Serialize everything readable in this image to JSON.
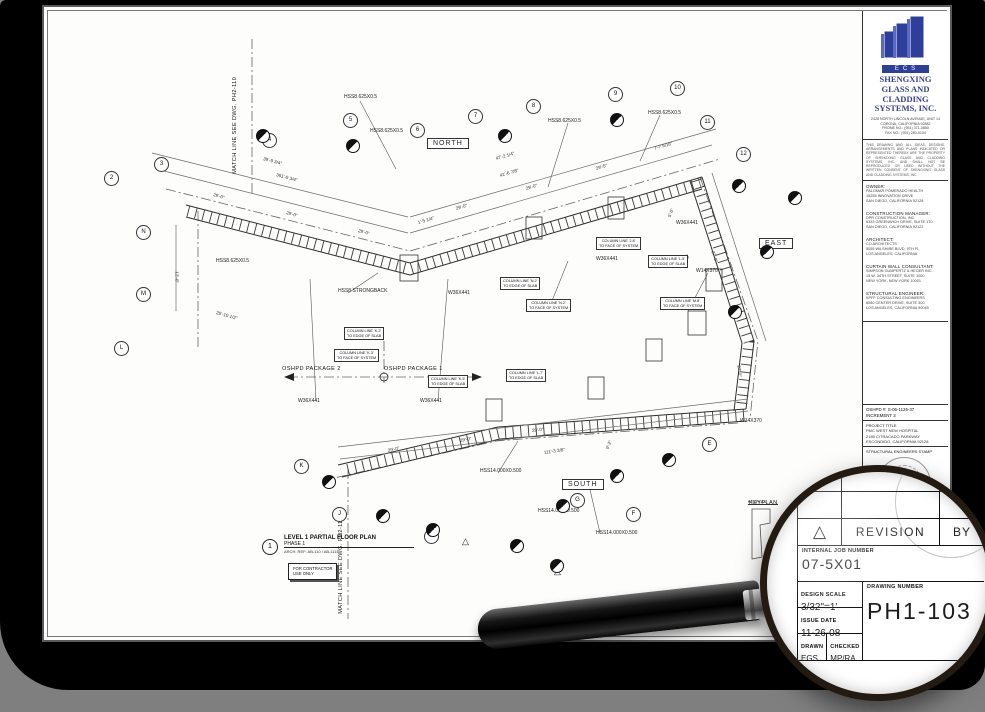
{
  "colors": {
    "canvas_bg": "#7f7f7f",
    "frame": "#000000",
    "sheet": "#fdfdfc",
    "logo_blue": "#2e3f9b",
    "company_text": "#39418e"
  },
  "plan": {
    "orientation": [
      {
        "t": "NORTH",
        "x": 379,
        "y": 127
      },
      {
        "t": "EAST",
        "x": 711,
        "y": 227
      },
      {
        "t": "SOUTH",
        "x": 514,
        "y": 468
      }
    ],
    "members": [
      {
        "t": "HSS8.625X0.5",
        "x": 296,
        "y": 84
      },
      {
        "t": "HSS8.625X0.5",
        "x": 322,
        "y": 118
      },
      {
        "t": "HSS8.625X0.5",
        "x": 500,
        "y": 108
      },
      {
        "t": "HSS8.625X0.5",
        "x": 600,
        "y": 100
      },
      {
        "t": "HSS8.625X0.5",
        "x": 168,
        "y": 248
      },
      {
        "t": "HSS8 STRONGBACK",
        "x": 290,
        "y": 278
      },
      {
        "t": "W36X441",
        "x": 250,
        "y": 388
      },
      {
        "t": "W36X441",
        "x": 372,
        "y": 388
      },
      {
        "t": "W36X441",
        "x": 400,
        "y": 280
      },
      {
        "t": "W36X441",
        "x": 548,
        "y": 246
      },
      {
        "t": "W36X441",
        "x": 628,
        "y": 210
      },
      {
        "t": "W14X370",
        "x": 648,
        "y": 258
      },
      {
        "t": "W14X370",
        "x": 692,
        "y": 408
      },
      {
        "t": "HSS14.000X0.500",
        "x": 432,
        "y": 458
      },
      {
        "t": "HSS14.000X0.500",
        "x": 490,
        "y": 498
      },
      {
        "t": "HSS14.000X0.500",
        "x": 548,
        "y": 520
      }
    ],
    "dims": [
      {
        "t": "39'-9 3/4\"",
        "x": 215,
        "y": 146,
        "r": 15
      },
      {
        "t": "361'-9 3/4\"",
        "x": 228,
        "y": 162,
        "r": 15
      },
      {
        "t": "29'-0\"",
        "x": 165,
        "y": 182,
        "r": 15
      },
      {
        "t": "29'-0\"",
        "x": 238,
        "y": 200,
        "r": 15
      },
      {
        "t": "29'-0\"",
        "x": 310,
        "y": 218,
        "r": 15
      },
      {
        "t": "47'-2 1/4\"",
        "x": 448,
        "y": 146,
        "r": -16
      },
      {
        "t": "41'-6 7/8\"",
        "x": 452,
        "y": 163,
        "r": -16
      },
      {
        "t": "29'-0\"",
        "x": 408,
        "y": 196,
        "r": -16
      },
      {
        "t": "29'-0\"",
        "x": 478,
        "y": 176,
        "r": -16
      },
      {
        "t": "29'-0\"",
        "x": 548,
        "y": 156,
        "r": -16
      },
      {
        "t": "7'-7 9/16\"",
        "x": 606,
        "y": 136,
        "r": -16
      },
      {
        "t": "1'-5 1/4\"",
        "x": 370,
        "y": 210,
        "r": -16
      },
      {
        "t": "12'-0\"",
        "x": 128,
        "y": 258,
        "r": 90
      },
      {
        "t": "25'-10 1/2\"",
        "x": 168,
        "y": 300,
        "r": 15
      },
      {
        "t": "27'-0\"",
        "x": 664,
        "y": 238,
        "r": 72
      },
      {
        "t": "27'-0\"",
        "x": 690,
        "y": 352,
        "r": 84
      },
      {
        "t": "5'-0\"",
        "x": 622,
        "y": 204,
        "r": -70
      },
      {
        "t": "5'-0\"",
        "x": 638,
        "y": 250,
        "r": -70
      },
      {
        "t": "29'-0\"",
        "x": 340,
        "y": 438,
        "r": -12
      },
      {
        "t": "29'-0\"",
        "x": 412,
        "y": 428,
        "r": -10
      },
      {
        "t": "29'-0\"",
        "x": 484,
        "y": 418,
        "r": -6
      },
      {
        "t": "111'-3 3/8\"",
        "x": 496,
        "y": 440,
        "r": -8
      },
      {
        "t": "9'-2\"",
        "x": 560,
        "y": 436,
        "r": -70
      }
    ],
    "notes": [
      {
        "t": "OSHPD PACKAGE 2",
        "x": 234,
        "y": 356
      },
      {
        "t": "OSHPD PACKAGE 1",
        "x": 336,
        "y": 356
      },
      {
        "t": "KEYPLAN",
        "x": 701,
        "y": 490
      },
      {
        "t": "MATCH LINE  SEE DWG. PH2-110",
        "x": 188,
        "y": 160,
        "r": -90
      },
      {
        "t": "MATCH LINE  SEE DWG. PH2-114",
        "x": 294,
        "y": 600,
        "r": -90
      }
    ],
    "callouts": [
      {
        "l": [
          "COLUMN LINE 'N.2'",
          "TO EDGE OF SLAB"
        ],
        "x": 452,
        "y": 266
      },
      {
        "l": [
          "COLUMN LINE 'N.2'",
          "TO FACE OF SYSTEM"
        ],
        "x": 478,
        "y": 288
      },
      {
        "l": [
          "COLUMN LINE 'J.8'",
          "TO FACE OF SYSTEM"
        ],
        "x": 548,
        "y": 226
      },
      {
        "l": [
          "COLUMN LINE 'L.5'",
          "TO EDGE OF SLAB"
        ],
        "x": 600,
        "y": 244
      },
      {
        "l": [
          "COLUMN LINE 'K.2'",
          "TO EDGE OF SLAB"
        ],
        "x": 296,
        "y": 316
      },
      {
        "l": [
          "COLUMN LINE 'K.3'",
          "TO FACE OF SYSTEM"
        ],
        "x": 286,
        "y": 338
      },
      {
        "l": [
          "COLUMN LINE 'K.5'",
          "TO EDGE OF SLAB"
        ],
        "x": 380,
        "y": 364
      },
      {
        "l": [
          "COLUMN LINE 'L.7'",
          "TO EDGE OF SLAB"
        ],
        "x": 458,
        "y": 358
      },
      {
        "l": [
          "COLUMN LINE 'M.8'",
          "TO FACE OF SYSTEM"
        ],
        "x": 612,
        "y": 286
      }
    ],
    "bubbles": [
      {
        "t": "2",
        "x": 56,
        "y": 160
      },
      {
        "t": "3",
        "x": 106,
        "y": 146
      },
      {
        "t": "4",
        "x": 214,
        "y": 122
      },
      {
        "t": "5",
        "x": 295,
        "y": 102
      },
      {
        "t": "6",
        "x": 362,
        "y": 112
      },
      {
        "t": "7",
        "x": 420,
        "y": 98
      },
      {
        "t": "8",
        "x": 478,
        "y": 88
      },
      {
        "t": "9",
        "x": 560,
        "y": 76
      },
      {
        "t": "10",
        "x": 622,
        "y": 70
      },
      {
        "t": "11",
        "x": 652,
        "y": 104
      },
      {
        "t": "12",
        "x": 688,
        "y": 136
      },
      {
        "t": "N",
        "x": 88,
        "y": 214
      },
      {
        "t": "M",
        "x": 88,
        "y": 276
      },
      {
        "t": "L",
        "x": 66,
        "y": 330
      },
      {
        "t": "K",
        "x": 246,
        "y": 448
      },
      {
        "t": "J",
        "x": 284,
        "y": 496
      },
      {
        "t": "H",
        "x": 376,
        "y": 518
      },
      {
        "t": "G",
        "x": 522,
        "y": 482
      },
      {
        "t": "F",
        "x": 578,
        "y": 496
      },
      {
        "t": "E",
        "x": 654,
        "y": 426
      }
    ],
    "markers": [
      {
        "x": 208,
        "y": 118
      },
      {
        "x": 298,
        "y": 128
      },
      {
        "x": 450,
        "y": 118
      },
      {
        "x": 562,
        "y": 102
      },
      {
        "x": 684,
        "y": 168
      },
      {
        "x": 712,
        "y": 234
      },
      {
        "x": 680,
        "y": 294
      },
      {
        "x": 274,
        "y": 464
      },
      {
        "x": 508,
        "y": 488
      },
      {
        "x": 562,
        "y": 458
      },
      {
        "x": 328,
        "y": 498
      },
      {
        "x": 462,
        "y": 528
      },
      {
        "x": 502,
        "y": 548
      },
      {
        "x": 378,
        "y": 512
      },
      {
        "x": 614,
        "y": 442
      },
      {
        "x": 740,
        "y": 180
      }
    ],
    "deltas": [
      {
        "t": "△",
        "x": 414,
        "y": 526
      },
      {
        "t": "△",
        "x": 506,
        "y": 556
      }
    ],
    "title": {
      "num": "1",
      "name": "LEVEL 1  PARTIAL FLOOR PLAN",
      "phase": "PHASE 1",
      "ref": "ARCH. REF: AB-110 / AB-111E",
      "contractor_lines": [
        "FOR CONTRACTOR",
        "USE ONLY"
      ]
    }
  },
  "titleblock": {
    "logo_text": "ECS",
    "company_lines": [
      "SHENGXING",
      "GLASS AND",
      "CLADDING",
      "SYSTEMS, INC."
    ],
    "address_lines": [
      "2428 NORTH LINCOLN AVENUE, UNIT 14",
      "CORONA, CALIFORNIA 92882",
      "PHONE NO.: (951) 371-0850",
      "FAX NO.: (951) 280-0104"
    ],
    "disclaimer": "THIS DRAWING AND ALL IDEAS, DESIGNS, ARRANGEMENTS AND PLANS INDICATED OR REPRESENTED THEREBY ARE THE PROPERTY OF SHENGXING GLASS AND CLADDING SYSTEMS, INC. AND SHALL NOT BE REPRODUCED OR USED WITHOUT THE WRITTEN CONSENT OF SHENGXING GLASS AND CLADDING SYSTEMS, INC.",
    "sections": [
      {
        "h": "OWNER:",
        "lines": [
          "PALOMAR POMERADO HEALTH",
          "15255 INNOVATION DRIVE",
          "SAN DIEGO, CALIFORNIA 92128"
        ]
      },
      {
        "h": "CONSTRUCTION MANAGER:",
        "lines": [
          "DPR CONSTRUCTION, INC.",
          "6333 GREENWICH DRIVE, SUITE 170",
          "SAN DIEGO, CALIFORNIA 92122"
        ]
      },
      {
        "h": "ARCHITECT:",
        "lines": [
          "CO ARCHITECTS",
          "5055 WILSHIRE BLVD, 9TH FL",
          "LOS ANGELES, CALIFORNIA"
        ]
      },
      {
        "h": "CURTAIN WALL CONSULTANT:",
        "lines": [
          "SIMPSON GUMPERTZ & HEGER INC.",
          "19 W. 34TH STREET, SUITE 1000",
          "NEW YORK, NEW YORK 10001"
        ]
      },
      {
        "h": "STRUCTURAL ENGINEER:",
        "lines": [
          "KPFF CONSULTING ENGINEERS",
          "6080 CENTER DRIVE, SUITE 300",
          "LOS ANGELES, CALIFORNIA 90045"
        ]
      }
    ],
    "oshpd_line1": "OSHPD #: S-06-1126-37",
    "oshpd_line2": "INCREMENT 3",
    "project_label": "PROJECT TITLE",
    "project_lines": [
      "PMC WEST NEW HOSPITAL",
      "2185 CITRACADO PARKWAY",
      "ESCONDIDO, CALIFORNIA 92128"
    ],
    "stamp_label": "STRUCTURAL ENGINEERS STAMP",
    "delta": "△",
    "revision_label": "REVISION",
    "by_label": "BY",
    "job_label": "INTERNAL JOB NUMBER",
    "job_number": "07-5X01",
    "scale_label": "DESIGN SCALE",
    "scale_value": "3/32\"=1'",
    "date_label": "ISSUE DATE",
    "date_value": "11-26-08",
    "drawn_label": "DRAWN",
    "drawn_value": "EGS",
    "checked_label": "CHECKED",
    "checked_value": "MP/RA",
    "dwg_label": "DRAWING NUMBER",
    "dwg_number": "PH1-103"
  }
}
